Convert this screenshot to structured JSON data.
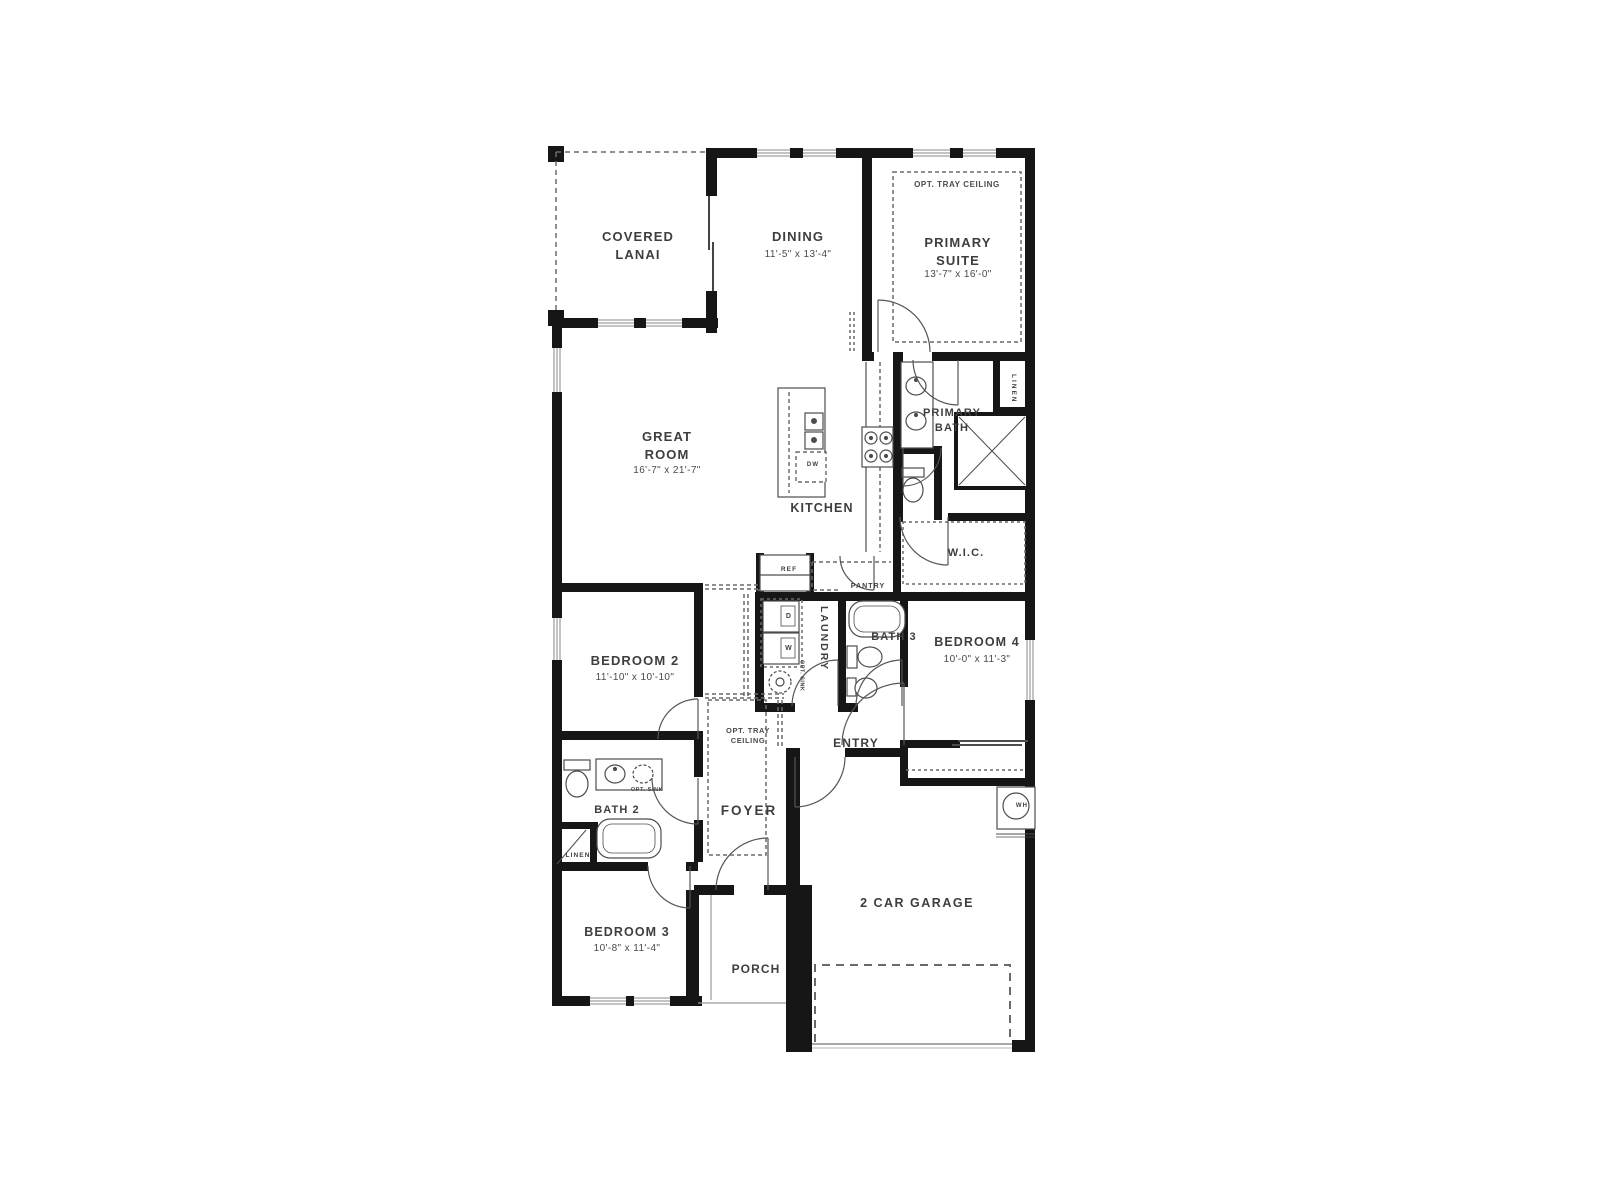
{
  "floorplan": {
    "rooms": {
      "covered_lanai": {
        "name": "COVERED LANAI"
      },
      "dining": {
        "name": "DINING",
        "dims": "11'-5\" x 13'-4\""
      },
      "primary_suite": {
        "name": "PRIMARY SUITE",
        "dims": "13'-7\" x 16'-0\"",
        "option": "OPT. TRAY CEILING"
      },
      "great_room": {
        "name": "GREAT ROOM",
        "dims": "16'-7\" x 21'-7\""
      },
      "kitchen": {
        "name": "KITCHEN"
      },
      "primary_bath": {
        "name": "PRIMARY BATH"
      },
      "wic": {
        "name": "W.I.C."
      },
      "bedroom_2": {
        "name": "BEDROOM 2",
        "dims": "11'-10\" x 10'-10\""
      },
      "bath_3": {
        "name": "BATH 3"
      },
      "bedroom_4": {
        "name": "BEDROOM 4",
        "dims": "10'-0\" x 11'-3\""
      },
      "laundry": {
        "name": "LAUNDRY"
      },
      "entry": {
        "name": "ENTRY"
      },
      "foyer": {
        "name": "FOYER",
        "option": "OPT. TRAY CEILING"
      },
      "bath_2": {
        "name": "BATH 2"
      },
      "bedroom_3": {
        "name": "BEDROOM 3",
        "dims": "10'-8\" x 11'-4\""
      },
      "porch": {
        "name": "PORCH"
      },
      "garage": {
        "name": "2 CAR GARAGE"
      }
    },
    "fixtures": {
      "ref": "REF",
      "pantry": "PANTRY",
      "dw": "DW",
      "dryer": "D",
      "washer": "W",
      "wh": "WH",
      "linen": "LINEN",
      "opt_sink": "OPT. SINK"
    },
    "colors": {
      "wall": "#161616",
      "fixture_line": "#4d4d4d",
      "dashed_line": "#6a6a6a",
      "text": "#3e3e3e",
      "background": "#ffffff"
    }
  }
}
